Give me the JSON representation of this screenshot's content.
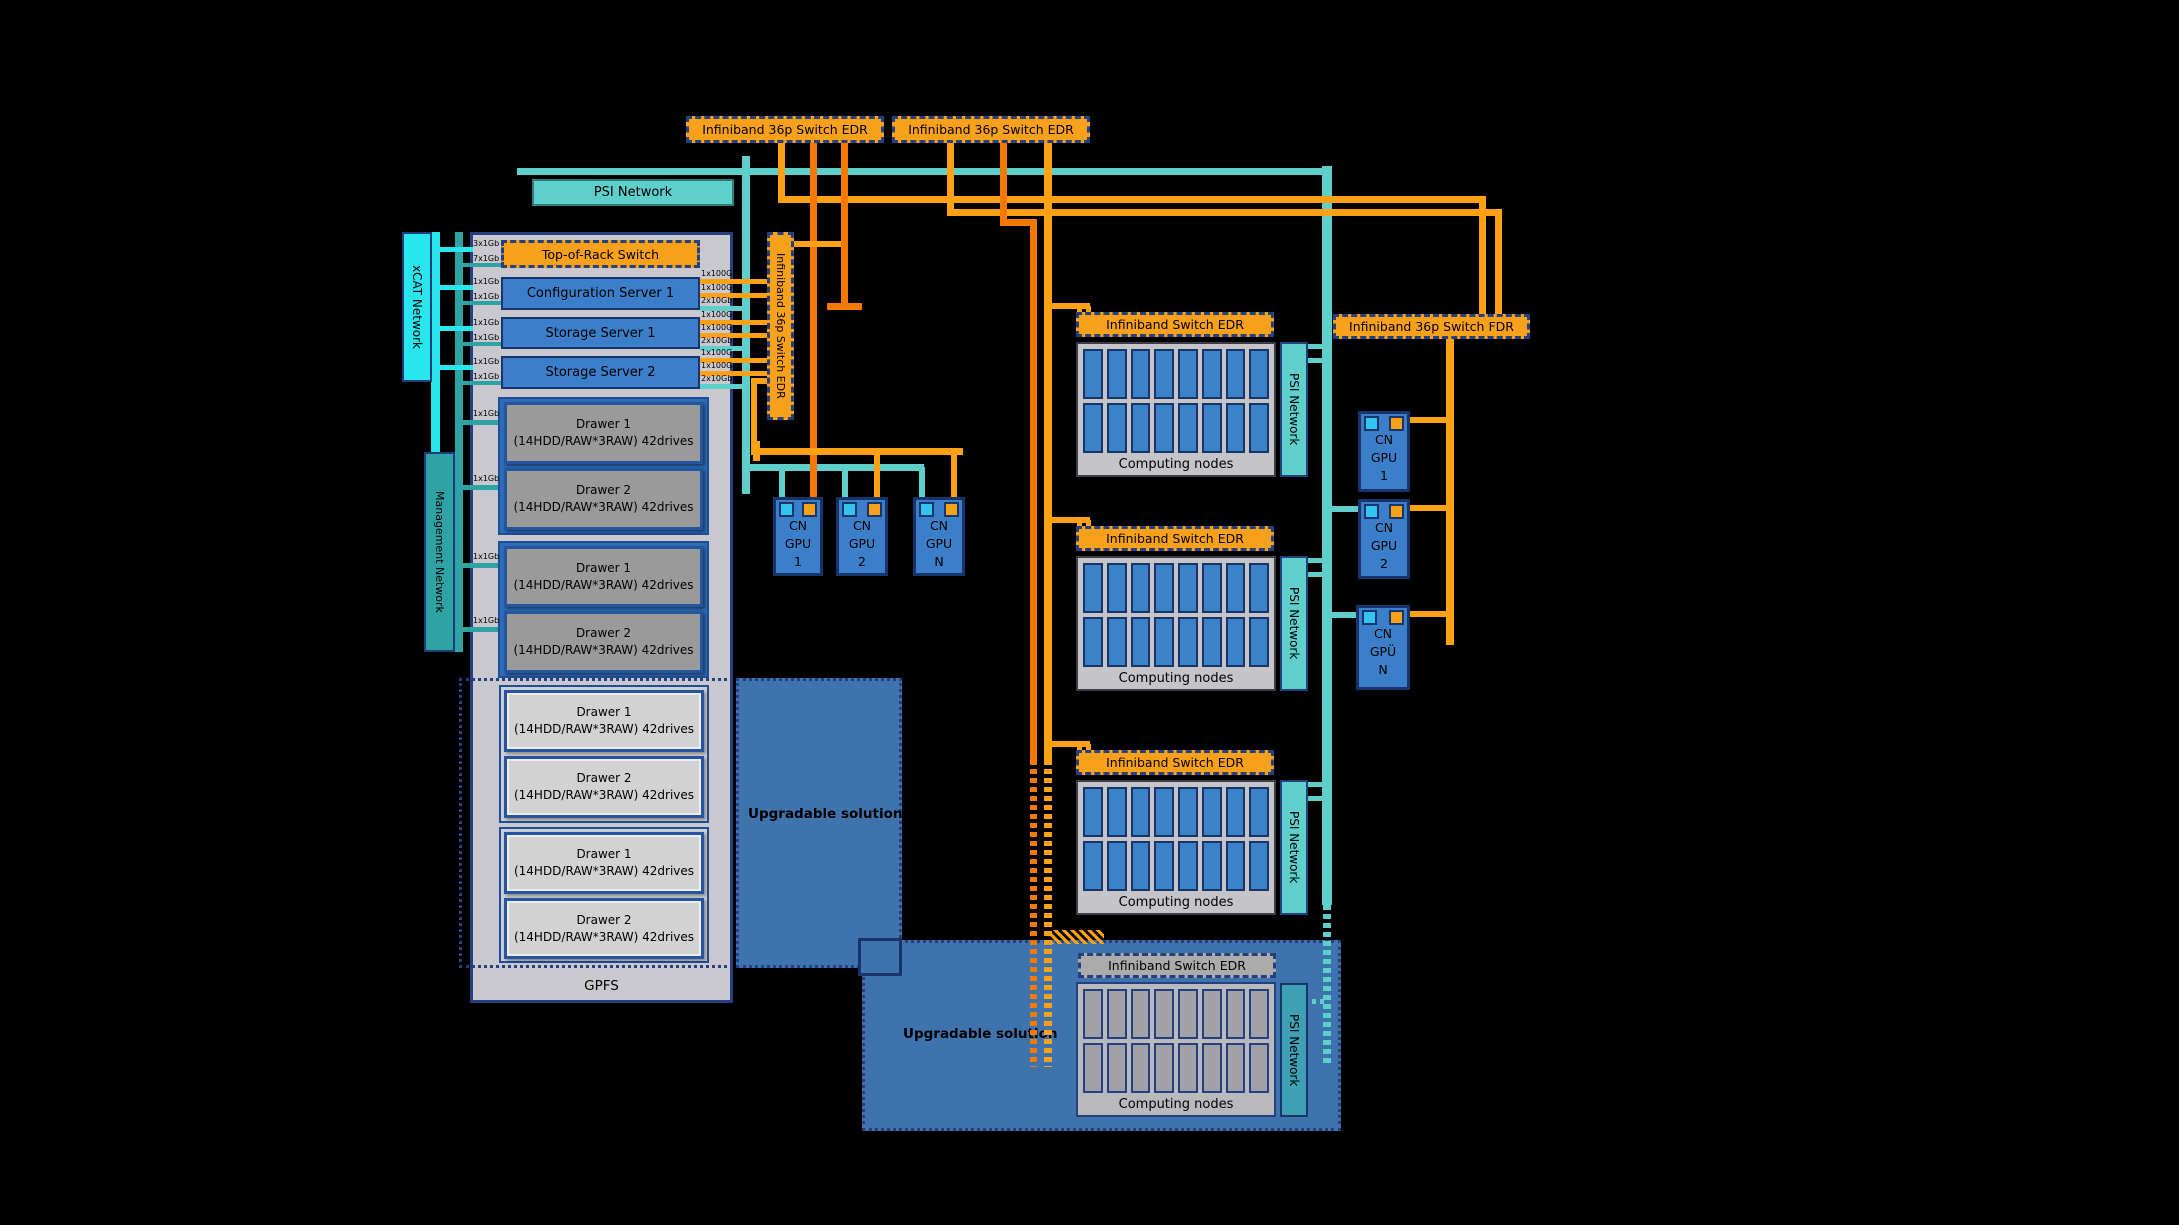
{
  "colors": {
    "background": "#000000",
    "orange_box": "#F9A11B",
    "orange_line": "#FFA114",
    "orange_dark_line": "#F57900",
    "teal": "#5ECFCB",
    "management_teal": "#2FA3A3",
    "xcat_cyan": "#29E5EE",
    "server_blue": "#3B7EC9",
    "node_cell_blue": "#3B82C8",
    "steel_blue": "#3E73AD",
    "navy_border": "#17356B",
    "panel_gray": "#C8C8CE"
  },
  "top": {
    "switch1": "Infiniband 36p Switch EDR",
    "switch2": "Infiniband 36p Switch EDR",
    "psi": "PSI Network"
  },
  "rack": {
    "xcat": "xCAT Network",
    "mgmt": "Management Network",
    "gpfs": "GPFS",
    "tor": "Top-of-Rack Switch",
    "servers": [
      "Configuration Server 1",
      "Storage Server 1",
      "Storage Server 2"
    ],
    "links_left": [
      "3x1Gb",
      "7x1Gb",
      "1x1Gb",
      "1x1Gb",
      "1x1Gb",
      "1x1Gb",
      "1x1Gb",
      "1x1Gb"
    ],
    "links_right": [
      "1x100G",
      "1x100G",
      "2x10Gb",
      "1x100G",
      "1x100G",
      "2x10Gb",
      "1x100G",
      "1x100G",
      "2x10Gb"
    ],
    "drawer_links": [
      "1x1Gb",
      "1x1Gb",
      "1x1Gb",
      "1x1Gb"
    ],
    "drawers": [
      {
        "title": "Drawer 1",
        "sub": "(14HDD/RAW*3RAW) 42drives"
      },
      {
        "title": "Drawer 2",
        "sub": "(14HDD/RAW*3RAW) 42drives"
      },
      {
        "title": "Drawer 1",
        "sub": "(14HDD/RAW*3RAW) 42drives"
      },
      {
        "title": "Drawer 2",
        "sub": "(14HDD/RAW*3RAW) 42drives"
      },
      {
        "title": "Drawer 1",
        "sub": "(14HDD/RAW*3RAW) 42drives"
      },
      {
        "title": "Drawer 2",
        "sub": "(14HDD/RAW*3RAW) 42drives"
      },
      {
        "title": "Drawer 1",
        "sub": "(14HDD/RAW*3RAW) 42drives"
      },
      {
        "title": "Drawer 2",
        "sub": "(14HDD/RAW*3RAW) 42drives"
      }
    ]
  },
  "ib_vertical": "Infiniband 36p Switch EDR",
  "fdr": "Infiniband 36p Switch FDR",
  "gpus_center": [
    {
      "l1": "CN",
      "l2": "GPU",
      "l3": "1"
    },
    {
      "l1": "CN",
      "l2": "GPU",
      "l3": "2"
    },
    {
      "l1": "CN",
      "l2": "GPU",
      "l3": "N"
    }
  ],
  "gpus_right": [
    {
      "l1": "CN",
      "l2": "GPU",
      "l3": "1"
    },
    {
      "l1": "CN",
      "l2": "GPU",
      "l3": "2"
    },
    {
      "l1": "CN",
      "l2": "GPÜ",
      "l3": "N"
    }
  ],
  "groups": [
    {
      "sw": "Infiniband Switch EDR",
      "nodes": "Computing nodes",
      "psi": "PSI Network",
      "link": "10"
    },
    {
      "sw": "Infiniband Switch EDR",
      "nodes": "Computing nodes",
      "psi": "PSI Network",
      "link": "10"
    },
    {
      "sw": "Infiniband Switch EDR",
      "nodes": "Computing nodes",
      "psi": "PSI Network",
      "link": "10"
    }
  ],
  "upgradable_left": "Upgradable solution",
  "bottom": {
    "label": "Upgradable solution",
    "sw": "Infiniband Switch EDR",
    "nodes": "Computing nodes",
    "psi": "PSI Network"
  }
}
